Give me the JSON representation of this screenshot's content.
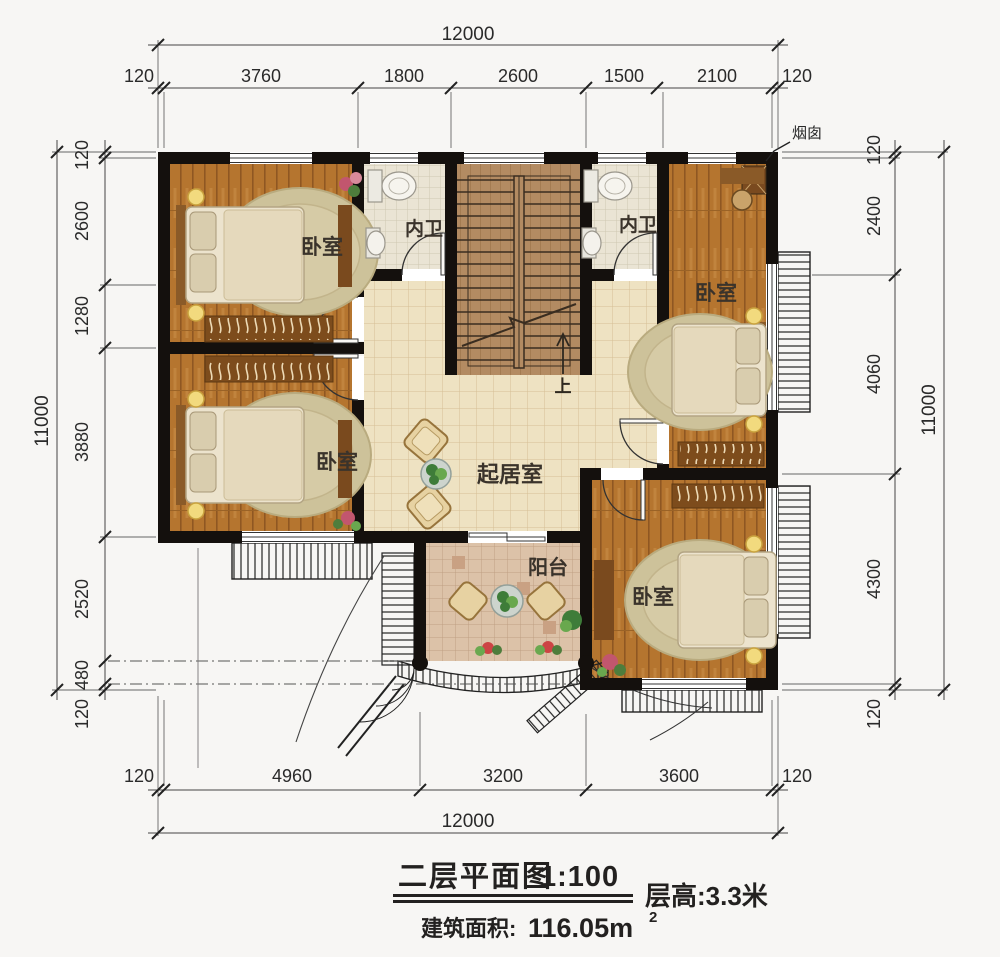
{
  "title_block": {
    "name": "二层平面图",
    "scale": "1:100",
    "floor_height": "层高:3.3米",
    "area_label": "建筑面积:",
    "area_value": "116.05m",
    "area_exp": "2"
  },
  "rooms": {
    "bedroom_top_left": {
      "label": "卧室"
    },
    "bedroom_bottom_left": {
      "label": "卧室"
    },
    "bedroom_top_right": {
      "label": "卧室"
    },
    "bedroom_bottom_right": {
      "label": "卧室"
    },
    "bath_left": {
      "label": "内卫"
    },
    "bath_right": {
      "label": "内卫"
    },
    "living": {
      "label": "起居室"
    },
    "balcony": {
      "label": "阳台"
    }
  },
  "annotations": {
    "chimney": "烟囱",
    "up": "上"
  },
  "dimensions": {
    "top": {
      "total": "12000",
      "segments": [
        "120",
        "3760",
        "1800",
        "2600",
        "1500",
        "2100",
        "120"
      ]
    },
    "bottom": {
      "total": "12000",
      "segments": [
        "120",
        "4960",
        "3200",
        "3600",
        "120"
      ]
    },
    "left": {
      "total": "11000",
      "segments": [
        "120",
        "2600",
        "1280",
        "3880",
        "2520",
        "480",
        "120"
      ]
    },
    "right": {
      "total": "11000",
      "segments": [
        "120",
        "2400",
        "4060",
        "4300",
        "120"
      ]
    }
  },
  "colors": {
    "wall": "#14100d",
    "wood_floor": "#b5752f",
    "living_tile": "#eee2c2",
    "bath_tile": "#eae4d4",
    "balcony_tile": "#dcc2a8",
    "stair_floor": "#b38b62"
  }
}
